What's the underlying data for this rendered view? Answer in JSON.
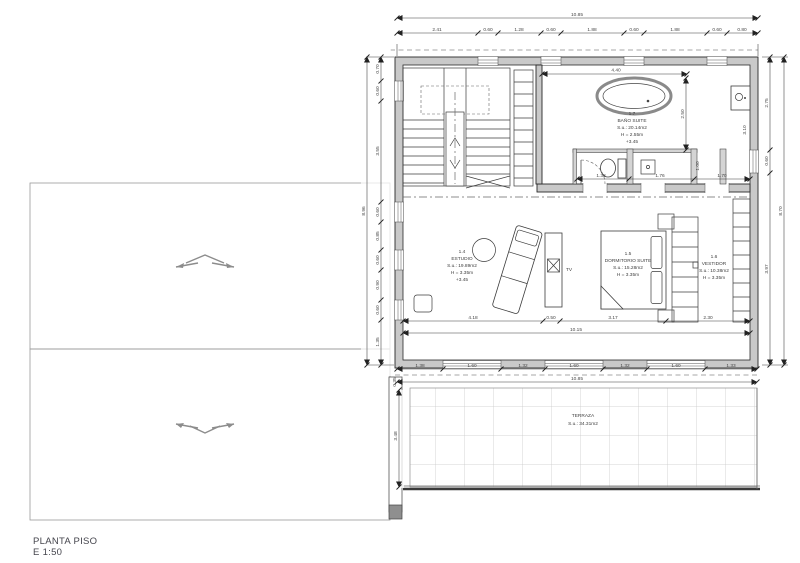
{
  "title_block": {
    "title": "PLANTA PISO",
    "scale": "E 1:50"
  },
  "labels": {
    "tv": "TV"
  },
  "rooms": {
    "bano": {
      "number": "1.7",
      "name": "BAÑO SUITE",
      "area": "S.u.: 20.14m2",
      "height": "H = 2.55m",
      "level": "+3.45"
    },
    "estudio": {
      "number": "1.4",
      "name": "ESTUDIO",
      "area": "S.u.: 19.89m2",
      "height": "H = 3.35m",
      "level": "+3.45"
    },
    "dormitorio": {
      "number": "1.5",
      "name": "DORMITORIO SUITE",
      "area": "S.u.: 15.28m2",
      "height": "H = 3.35m"
    },
    "vestidor": {
      "number": "1.6",
      "name": "VESTIDOR",
      "area": "S.u.: 10.38m2",
      "height": "H = 3.35m"
    },
    "terraza": {
      "name": "TERRAZA",
      "area": "S.u.: 34.31m2"
    }
  },
  "dims": {
    "top_total": "10.85",
    "top": [
      "2.41",
      "0.60",
      "1.28",
      "0.60",
      "1.88",
      "0.60",
      "1.88",
      "0.60",
      "0.80"
    ],
    "bottom": [
      "1.38",
      "1.60",
      "1.32",
      "1.60",
      "1.32",
      "1.60",
      "1.33"
    ],
    "bottom_total": "10.85",
    "left": [
      "0.70",
      "0.60",
      "3.55",
      "0.60",
      "0.85",
      "0.60",
      "0.90",
      "0.60",
      "1.35"
    ],
    "left_total": "8.96",
    "right": [
      "2.75",
      "0.60",
      "3.97"
    ],
    "right_total": "8.70",
    "interior": [
      "4.18",
      "0.50",
      "3.17",
      "2.30"
    ],
    "interior_total": "10.15",
    "bath": {
      "width": "4.40",
      "depth": "2.50",
      "wc": "1.38",
      "shower": "1.76",
      "basin": "1.70",
      "cubicle": "1.00",
      "closet": "3.10"
    },
    "terraza": {
      "depth": "3.48",
      "edge": "0.35"
    }
  }
}
